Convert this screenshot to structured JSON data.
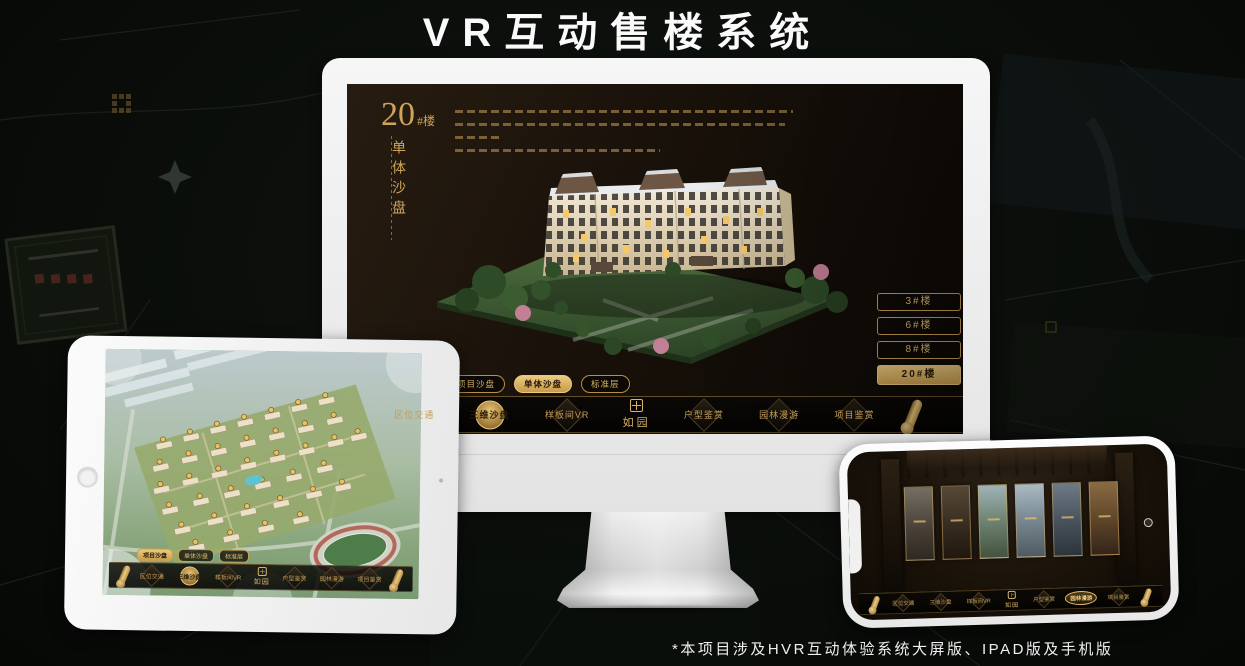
{
  "page": {
    "title": "VR互动售楼系统",
    "footnote": "*本项目涉及HVR互动体验系统大屏版、IPAD版及手机版"
  },
  "colors": {
    "background": "#0a0e0b",
    "gold": "#d0a85c",
    "gold_bright": "#ecc97e",
    "screen_dark": "#171009",
    "nav_bar": "#060504",
    "device_frame_white": "#f1f1f1",
    "active_text_dark": "#2a1d09"
  },
  "icons": {
    "scroll_icon": "gold rolled scroll (css shape)",
    "seal_icon": "gold seal grid square (css shape)",
    "diamond_emblem_icon": "rotated square medallion (css shape)",
    "home_button": "circle",
    "camera_icon": "dot"
  },
  "monitor": {
    "hero": {
      "number": "20",
      "suffix": "#楼",
      "subtitle": "单体沙盘"
    },
    "floor_buttons": [
      {
        "label": "3#楼",
        "active": false
      },
      {
        "label": "6#楼",
        "active": false
      },
      {
        "label": "8#楼",
        "active": false
      },
      {
        "label": "20#楼",
        "active": true
      }
    ],
    "tabs": [
      {
        "label": "项目沙盘",
        "active": false
      },
      {
        "label": "单体沙盘",
        "active": true
      },
      {
        "label": "标准层",
        "active": false
      }
    ],
    "nav": {
      "logo": "如园",
      "items": [
        {
          "label": "区位交通",
          "active": false
        },
        {
          "label": "三维沙盘",
          "active": true
        },
        {
          "label": "样板间VR",
          "active": false
        },
        {
          "label": "户型鉴赏",
          "active": false
        },
        {
          "label": "园林漫游",
          "active": false
        },
        {
          "label": "项目鉴赏",
          "active": false
        }
      ]
    }
  },
  "tablet": {
    "tabs": [
      {
        "label": "项目沙盘",
        "active": true
      },
      {
        "label": "单体沙盘",
        "active": false
      },
      {
        "label": "标准层",
        "active": false
      }
    ],
    "nav": {
      "logo": "如园",
      "items": [
        {
          "label": "区位交通",
          "active": false
        },
        {
          "label": "三维沙盘",
          "active": true
        },
        {
          "label": "样板间VR",
          "active": false
        },
        {
          "label": "户型鉴赏",
          "active": false
        },
        {
          "label": "园林漫游",
          "active": false
        },
        {
          "label": "项目鉴赏",
          "active": false
        }
      ]
    }
  },
  "phone": {
    "nav": {
      "logo": "如园",
      "items": [
        {
          "label": "区位交通",
          "active": false
        },
        {
          "label": "三维沙盘",
          "active": false
        },
        {
          "label": "样板间VR",
          "active": false
        },
        {
          "label": "户型鉴赏",
          "active": false
        },
        {
          "label": "园林漫游",
          "active": true
        },
        {
          "label": "项目鉴赏",
          "active": false
        }
      ]
    }
  }
}
